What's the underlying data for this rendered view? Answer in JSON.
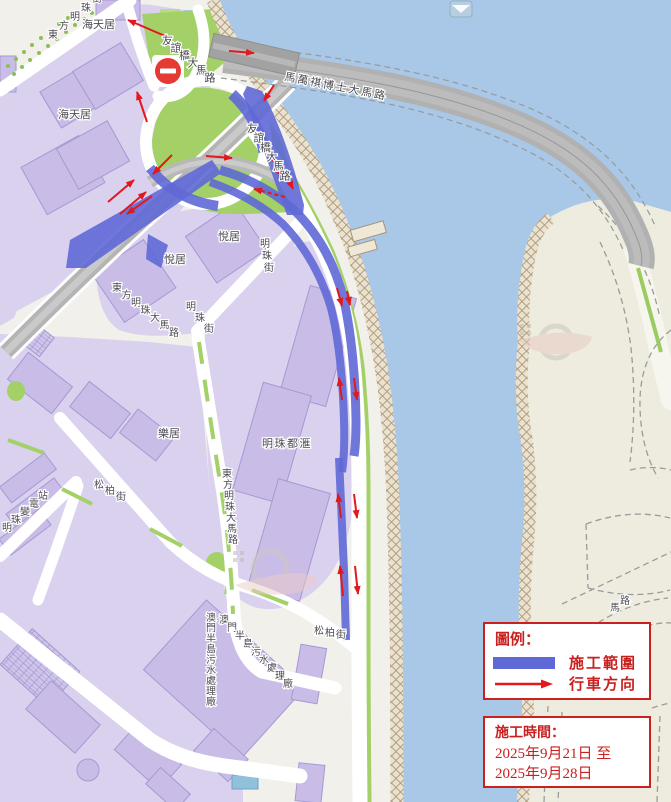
{
  "legend": {
    "title": "圖例：",
    "construction_area_label": "施工範圍",
    "traffic_direction_label": "行車方向"
  },
  "schedule": {
    "title": "施工時間：",
    "line1": "2025年9月21日 至",
    "line2": "2025年9月28日"
  },
  "icons": {
    "no_entry_sign": "red circle with white horizontal bar",
    "bridge_badge": "small blue route badge at top edge",
    "legend_arrow": "red right arrow"
  },
  "colors": {
    "water": "#a9c8e8",
    "land": "#f1f0ea",
    "island": "#edecdf",
    "block_purple": "#dad1ef",
    "building_purple": "#c9bde7",
    "green": "#a3d168",
    "road_gray": "#b1b1b1",
    "construction_blue": "#5f68d6",
    "arrow_red": "#e3181d",
    "legend_red": "#c92120",
    "label_gray": "#4a4a52"
  },
  "map_labels": [
    {
      "text": "東方明珠街",
      "x": 48,
      "y": 38,
      "step": [
        11,
        -9
      ],
      "size": 10
    },
    {
      "text": "海天居",
      "x": 82,
      "y": 28,
      "size": 11
    },
    {
      "text": "海天居",
      "x": 58,
      "y": 118,
      "size": 11
    },
    {
      "text": "友誼橋大馬路",
      "x": 162,
      "y": 44,
      "step": [
        8.5,
        7.5
      ],
      "size": 11
    },
    {
      "text": "友誼橋大馬路",
      "x": 247,
      "y": 132,
      "step": [
        6.5,
        9.5
      ],
      "size": 11
    },
    {
      "text": "馬萬祺博士大馬路",
      "x": 284,
      "y": 80,
      "rotate": 11,
      "size": 11,
      "spacing": 2
    },
    {
      "text": "悅居",
      "x": 218,
      "y": 240,
      "size": 11
    },
    {
      "text": "悅居",
      "x": 164,
      "y": 263,
      "size": 11
    },
    {
      "text": "明珠街",
      "x": 260,
      "y": 247,
      "step": [
        2,
        12
      ],
      "size": 10
    },
    {
      "text": "東方明珠大馬路",
      "x": 112,
      "y": 291,
      "step": [
        9.5,
        7.5
      ],
      "size": 10
    },
    {
      "text": "明珠街",
      "x": 186,
      "y": 310,
      "step": [
        9,
        11
      ],
      "size": 10
    },
    {
      "text": "東方明珠大馬路",
      "x": 222,
      "y": 477,
      "step": [
        1,
        11
      ],
      "size": 10
    },
    {
      "text": "明珠都滙",
      "x": 262,
      "y": 447,
      "size": 11,
      "spacing": 1.5
    },
    {
      "text": "樂居",
      "x": 158,
      "y": 437,
      "size": 11
    },
    {
      "text": "松柏街",
      "x": 94,
      "y": 488,
      "step": [
        11,
        6
      ],
      "size": 10
    },
    {
      "text": "松柏街",
      "x": 314,
      "y": 634,
      "step": [
        11,
        2
      ],
      "size": 10
    },
    {
      "text": "明珠變電站",
      "x": 2,
      "y": 531,
      "step": [
        9,
        -8
      ],
      "size": 10
    },
    {
      "text": "澳門半島污水處理廠",
      "x": 206,
      "y": 621,
      "step": [
        0,
        10.5
      ],
      "size": 10
    },
    {
      "text": "澳門半島污水處理廠",
      "x": 219,
      "y": 623,
      "step": [
        8,
        8
      ],
      "size": 10
    },
    {
      "text": "馬路",
      "x": 610,
      "y": 611,
      "step": [
        10,
        -7
      ],
      "size": 10
    }
  ]
}
